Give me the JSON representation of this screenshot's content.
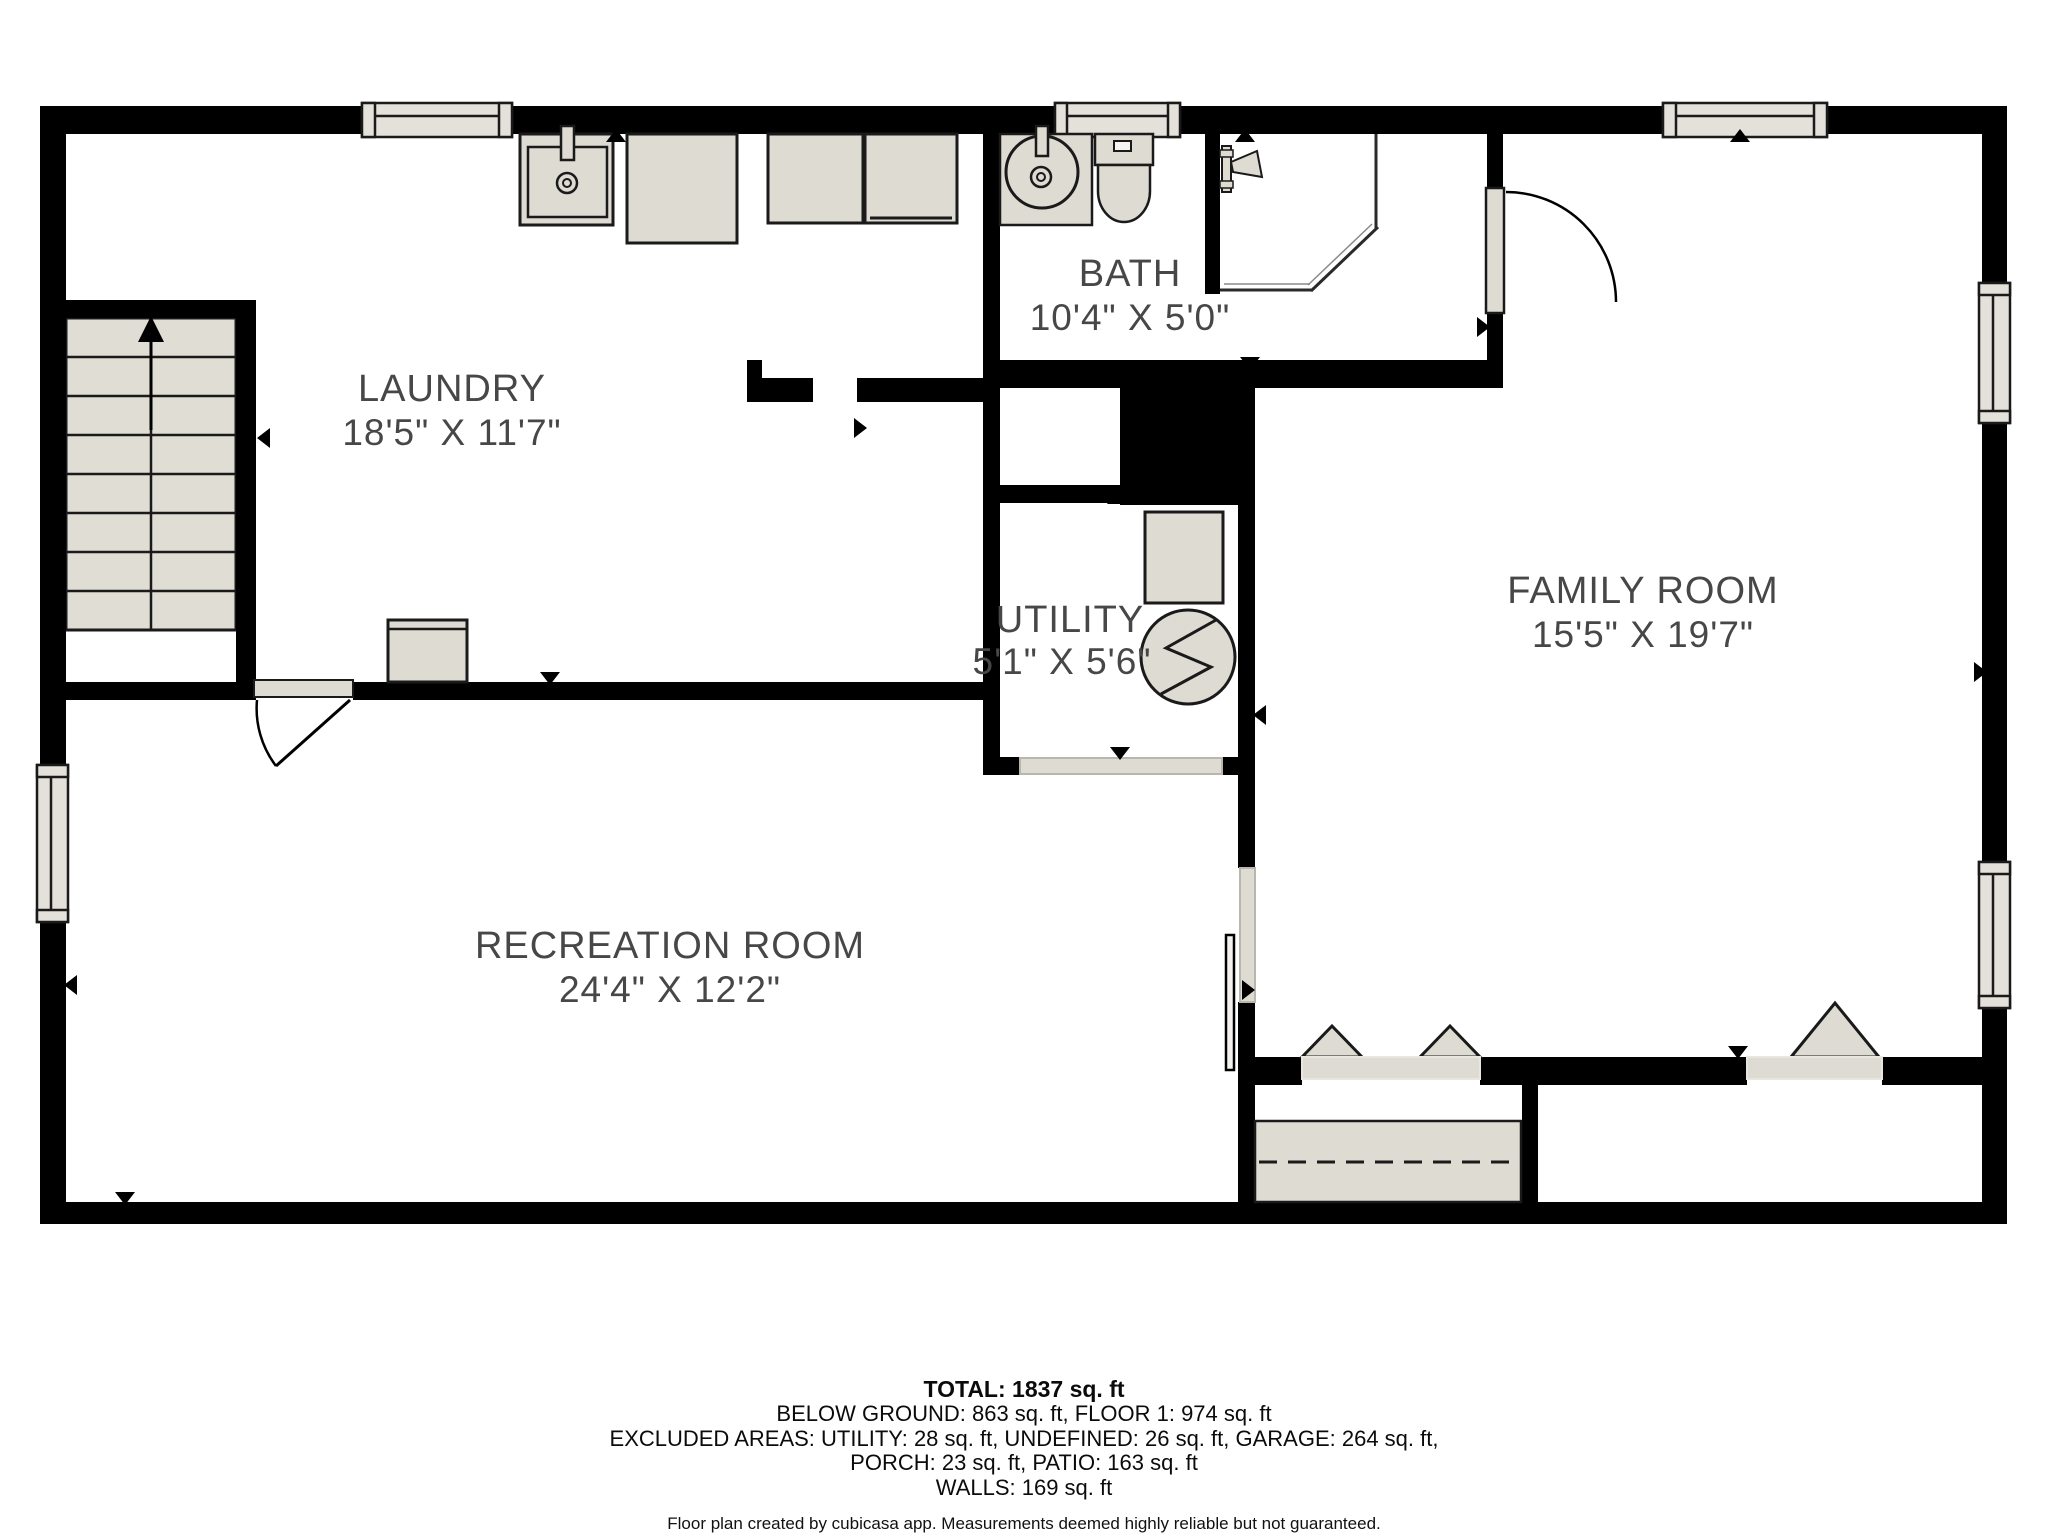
{
  "plan": {
    "rooms": [
      {
        "name": "LAUNDRY",
        "dims": "18'5\" X 11'7\""
      },
      {
        "name": "BATH",
        "dims": "10'4\" X 5'0\""
      },
      {
        "name": "UTILITY",
        "dims": "5'1\" X 5'6\""
      },
      {
        "name": "FAMILY ROOM",
        "dims": "15'5\" X 19'7\""
      },
      {
        "name": "RECREATION ROOM",
        "dims": "24'4\" X 12'2\""
      }
    ],
    "colors": {
      "wall": "#000000",
      "fixture_fill": "#dedbd3",
      "fixture_stroke": "#1a1a1a",
      "label_text": "#474747",
      "floor": "#ffffff"
    }
  },
  "footer": {
    "total": "TOTAL: 1837 sq. ft",
    "line2": "BELOW GROUND: 863 sq. ft, FLOOR 1: 974 sq. ft",
    "line3": "EXCLUDED AREAS: UTILITY: 28 sq. ft, UNDEFINED: 26 sq. ft, GARAGE: 264 sq. ft,",
    "line4": "PORCH: 23 sq. ft, PATIO: 163 sq. ft",
    "line5": "WALLS: 169 sq. ft",
    "disclaimer": "Floor plan created by cubicasa app. Measurements deemed highly reliable but not guaranteed."
  }
}
